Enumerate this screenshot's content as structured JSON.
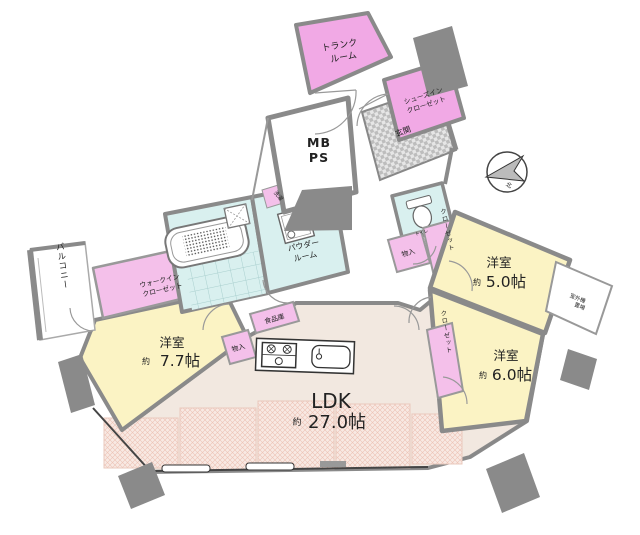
{
  "plan": {
    "compass": {
      "north_label": "北"
    },
    "trunk": {
      "line1": "トランク",
      "line2": "ルーム"
    },
    "shoes_closet": {
      "line1": "シューズイン",
      "line2": "クローゼット"
    },
    "entrance": {
      "label": "玄関"
    },
    "meter_box": {
      "line1": "MB",
      "line2": "PS"
    },
    "toilet": {
      "label": "トイレ"
    },
    "storage_right": {
      "label": "物入"
    },
    "closet_5": {
      "label": "クローゼット"
    },
    "room_5": {
      "name": "洋室",
      "approx": "約",
      "size": "5.0帖"
    },
    "outdoor_unit": {
      "line1": "室外機",
      "line2": "置場"
    },
    "room_6": {
      "name": "洋室",
      "approx": "約",
      "size": "6.0帖"
    },
    "closet_6": {
      "label": "クローゼット"
    },
    "ldk": {
      "name": "LDK",
      "approx": "約",
      "size": "27.0帖"
    },
    "pantry": {
      "label": "食品庫"
    },
    "storage_left": {
      "label": "物入"
    },
    "room_7": {
      "name": "洋室",
      "approx": "約",
      "size": "7.7帖"
    },
    "walk_in_closet": {
      "line1": "ウォークイン",
      "line2": "クローゼット"
    },
    "balcony": {
      "label": "バルコニー"
    },
    "laundry": {
      "label": "洗濯"
    },
    "powder": {
      "line1": "パウダー",
      "line2": "ルーム"
    }
  },
  "colors": {
    "pink_strong": "#f1a9e5",
    "pink": "#f4c0ea",
    "yellow": "#fbf3c4",
    "cyan": "#d9f0ef",
    "ldk_floor": "#f2e8e0",
    "wall_gray": "#8a8a8a",
    "hatch_pink": "#edc3b5"
  }
}
